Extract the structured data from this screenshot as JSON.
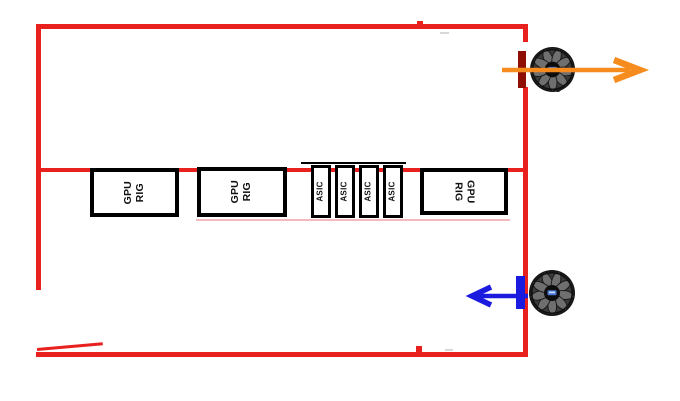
{
  "colors": {
    "wall": "#e8201e",
    "box_border": "#000000",
    "box_fill": "#ffffff",
    "exhaust_arrow": "#f68b1e",
    "intake_arrow": "#1b1be0",
    "exhaust_fan_mount": "#8e1004",
    "intake_fan_mount": "#1b1be0",
    "underline_artifact": "#f2babe"
  },
  "equipment": {
    "items": [
      {
        "id": "gpu-rig-1",
        "type": "gpu-rig",
        "label": "GPU\nRIG"
      },
      {
        "id": "gpu-rig-2",
        "type": "gpu-rig",
        "label": "GPU\nRIG"
      },
      {
        "id": "asic-1",
        "type": "asic",
        "label": "ASIC"
      },
      {
        "id": "asic-2",
        "type": "asic",
        "label": "ASIC"
      },
      {
        "id": "asic-3",
        "type": "asic",
        "label": "ASIC"
      },
      {
        "id": "asic-4",
        "type": "asic",
        "label": "ASIC"
      },
      {
        "id": "gpu-rig-3",
        "type": "gpu-rig",
        "label": "GPU\nRIG"
      }
    ]
  },
  "airflow": {
    "exhaust": {
      "icon": "axial-fan-icon",
      "arrow_direction": "right"
    },
    "intake": {
      "icon": "axial-fan-icon",
      "arrow_direction": "left"
    }
  }
}
